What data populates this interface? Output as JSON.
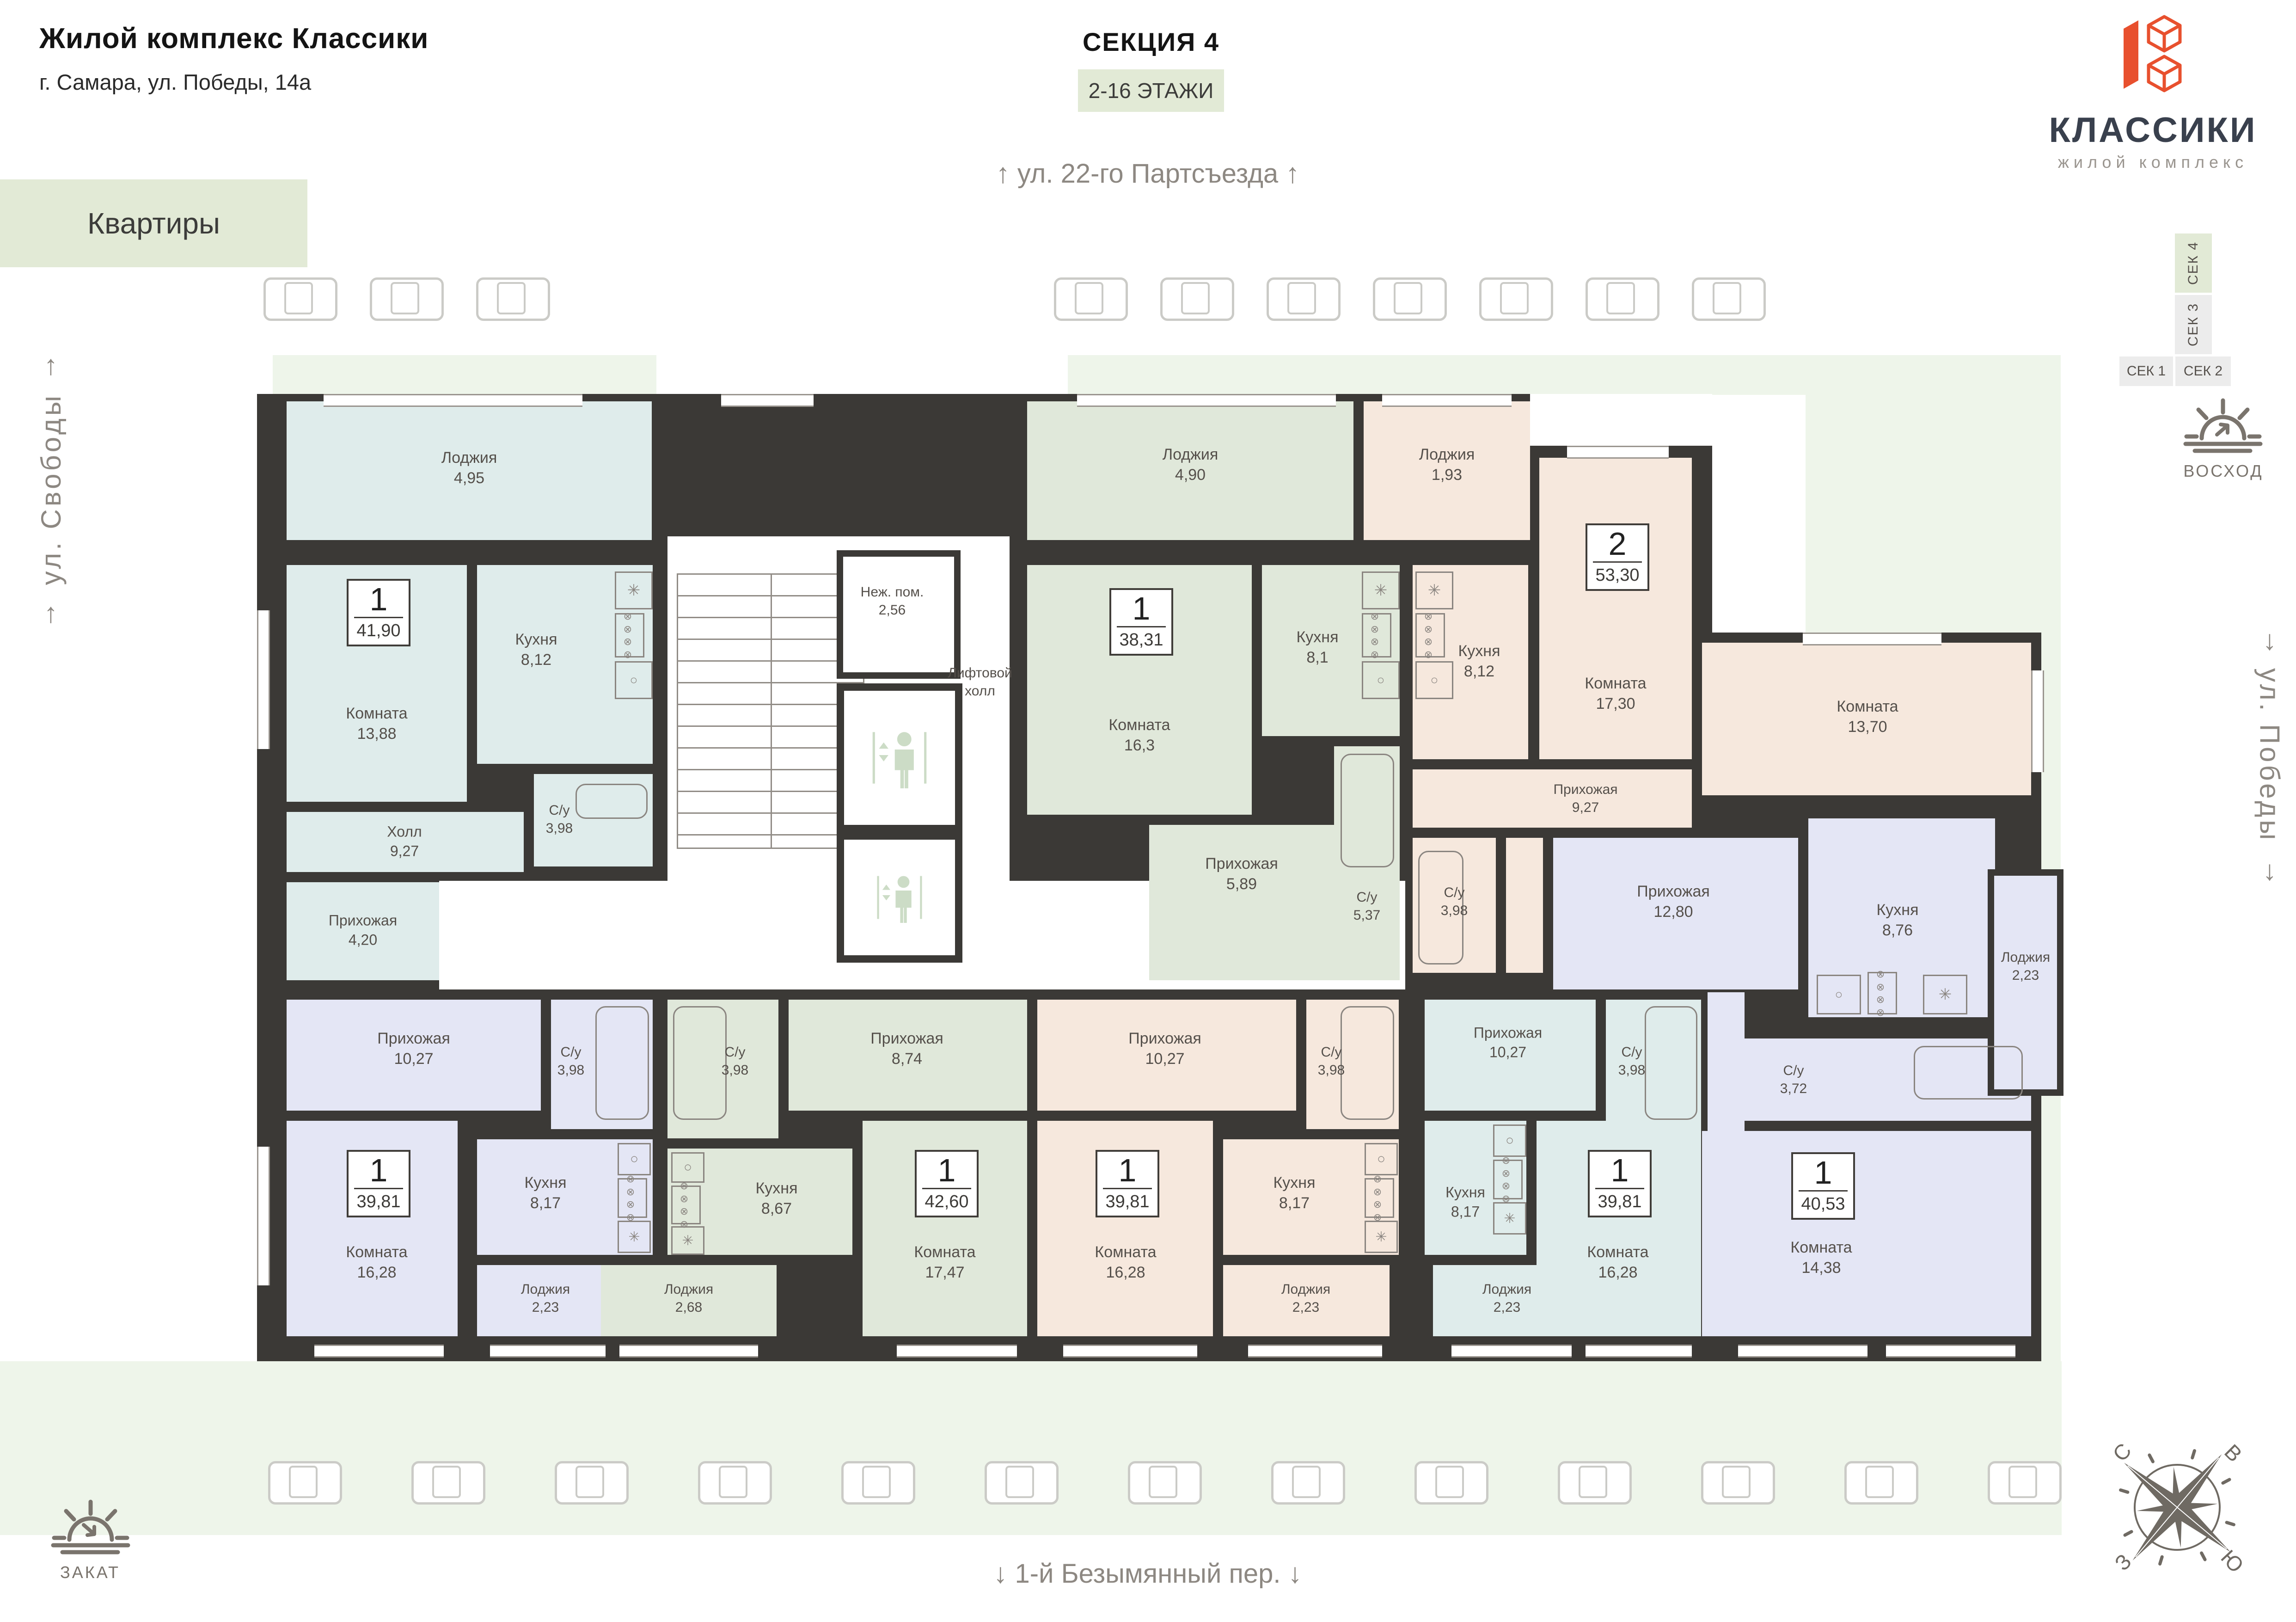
{
  "header": {
    "title": "Жилой комплекс Классики",
    "subtitle": "г. Самара, ул. Победы, 14а",
    "apartments_label": "Квартиры"
  },
  "section": {
    "title": "СЕКЦИЯ 4",
    "floors": "2-16 ЭТАЖИ"
  },
  "logo": {
    "name": "КЛАССИКИ",
    "tagline": "жилой комплекс"
  },
  "streets": {
    "top": "ул. 22-го Партсъезда",
    "left": "ул. Свободы",
    "right": "ул. Победы",
    "bottom": "1-й Безымянный пер."
  },
  "section_nav": [
    {
      "label": "СЕК 1",
      "active": false
    },
    {
      "label": "СЕК 2",
      "active": false
    },
    {
      "label": "СЕК 3",
      "active": false
    },
    {
      "label": "СЕК 4",
      "active": true
    }
  ],
  "orientation": {
    "sunrise": "ВОСХОД",
    "sunset": "ЗАКАТ",
    "compass": {
      "n": "С",
      "e": "В",
      "s": "Ю",
      "w": "З"
    }
  },
  "core": {
    "nezh": {
      "name": "Неж. пом.",
      "area": "2,56"
    },
    "lift_hall_line1": "Лифтовой",
    "lift_hall_line2": "холл"
  },
  "icons": {
    "stove": "⊗ ⊗ ⊗ ⊗",
    "fridge": "✳",
    "sink": "○",
    "arrow_up": "↑",
    "arrow_down": "↓"
  },
  "apartments": [
    {
      "id": "1",
      "type": "1",
      "total_area": "41,90",
      "rooms": {
        "lodzhia": {
          "name": "Лоджия",
          "area": "4,95"
        },
        "komnata": {
          "name": "Комната",
          "area": "13,88"
        },
        "kuhnya": {
          "name": "Кухня",
          "area": "8,12"
        },
        "su": {
          "name": "С/у",
          "area": "3,98"
        },
        "holl": {
          "name": "Холл",
          "area": "9,27"
        },
        "prihozhaya": {
          "name": "Прихожая",
          "area": "4,20"
        }
      }
    },
    {
      "id": "2",
      "type": "1",
      "total_area": "38,31",
      "rooms": {
        "lodzhia": {
          "name": "Лоджия",
          "area": "4,90"
        },
        "komnata": {
          "name": "Комната",
          "area": "16,3"
        },
        "kuhnya": {
          "name": "Кухня",
          "area": "8,1"
        },
        "prihozhaya": {
          "name": "Прихожая",
          "area": "5,89"
        },
        "su": {
          "name": "С/у",
          "area": "5,37"
        }
      }
    },
    {
      "id": "3",
      "type": "2",
      "total_area": "53,30",
      "rooms": {
        "lodzhia": {
          "name": "Лоджия",
          "area": "1,93"
        },
        "kuhnya": {
          "name": "Кухня",
          "area": "8,12"
        },
        "komnata1": {
          "name": "Комната",
          "area": "17,30"
        },
        "komnata2": {
          "name": "Комната",
          "area": "13,70"
        },
        "su": {
          "name": "С/у",
          "area": "3,98"
        },
        "prihozhaya": {
          "name": "Прихожая",
          "area": "9,27"
        }
      }
    },
    {
      "id": "4",
      "type": "1",
      "total_area": "40,53",
      "rooms": {
        "prihozhaya": {
          "name": "Прихожая",
          "area": "12,80"
        },
        "kuhnya": {
          "name": "Кухня",
          "area": "8,76"
        },
        "lodzhia": {
          "name": "Лоджия",
          "area": "2,23"
        },
        "su": {
          "name": "С/у",
          "area": "3,72"
        },
        "komnata": {
          "name": "Комната",
          "area": "14,38"
        }
      }
    },
    {
      "id": "5",
      "type": "1",
      "total_area": "39,81",
      "rooms": {
        "prihozhaya": {
          "name": "Прихожая",
          "area": "10,27"
        },
        "su": {
          "name": "С/у",
          "area": "3,98"
        },
        "komnata": {
          "name": "Комната",
          "area": "16,28"
        },
        "kuhnya": {
          "name": "Кухня",
          "area": "8,17"
        },
        "lodzhia": {
          "name": "Лоджия",
          "area": "2,23"
        }
      }
    },
    {
      "id": "6",
      "type": "1",
      "total_area": "42,60",
      "rooms": {
        "su": {
          "name": "С/у",
          "area": "3,98"
        },
        "prihozhaya": {
          "name": "Прихожая",
          "area": "8,74"
        },
        "kuhnya": {
          "name": "Кухня",
          "area": "8,67"
        },
        "komnata": {
          "name": "Комната",
          "area": "17,47"
        },
        "lodzhia": {
          "name": "Лоджия",
          "area": "2,68"
        }
      }
    },
    {
      "id": "7",
      "type": "1",
      "total_area": "39,81",
      "rooms": {
        "prihozhaya": {
          "name": "Прихожая",
          "area": "10,27"
        },
        "su": {
          "name": "С/у",
          "area": "3,98"
        },
        "komnata": {
          "name": "Комната",
          "area": "16,28"
        },
        "kuhnya": {
          "name": "Кухня",
          "area": "8,17"
        },
        "lodzhia": {
          "name": "Лоджия",
          "area": "2,23"
        }
      }
    },
    {
      "id": "8",
      "type": "1",
      "total_area": "39,81",
      "rooms": {
        "su": {
          "name": "С/у",
          "area": "3,98"
        },
        "prihozhaya": {
          "name": "Прихожая",
          "area": "10,27"
        },
        "kuhnya": {
          "name": "Кухня",
          "area": "8,17"
        },
        "komnata": {
          "name": "Комната",
          "area": "16,28"
        },
        "lodzhia": {
          "name": "Лоджия",
          "area": "2,23"
        }
      }
    }
  ],
  "colors": {
    "wall": "#3b3936",
    "teal": "#dfeceb",
    "green": "#e0e8da",
    "pink": "#f6e8dd",
    "lavender": "#e4e6f5",
    "site": "#eef5ea",
    "box_green": "#e2ead6",
    "brand_red": "#e8502e"
  }
}
